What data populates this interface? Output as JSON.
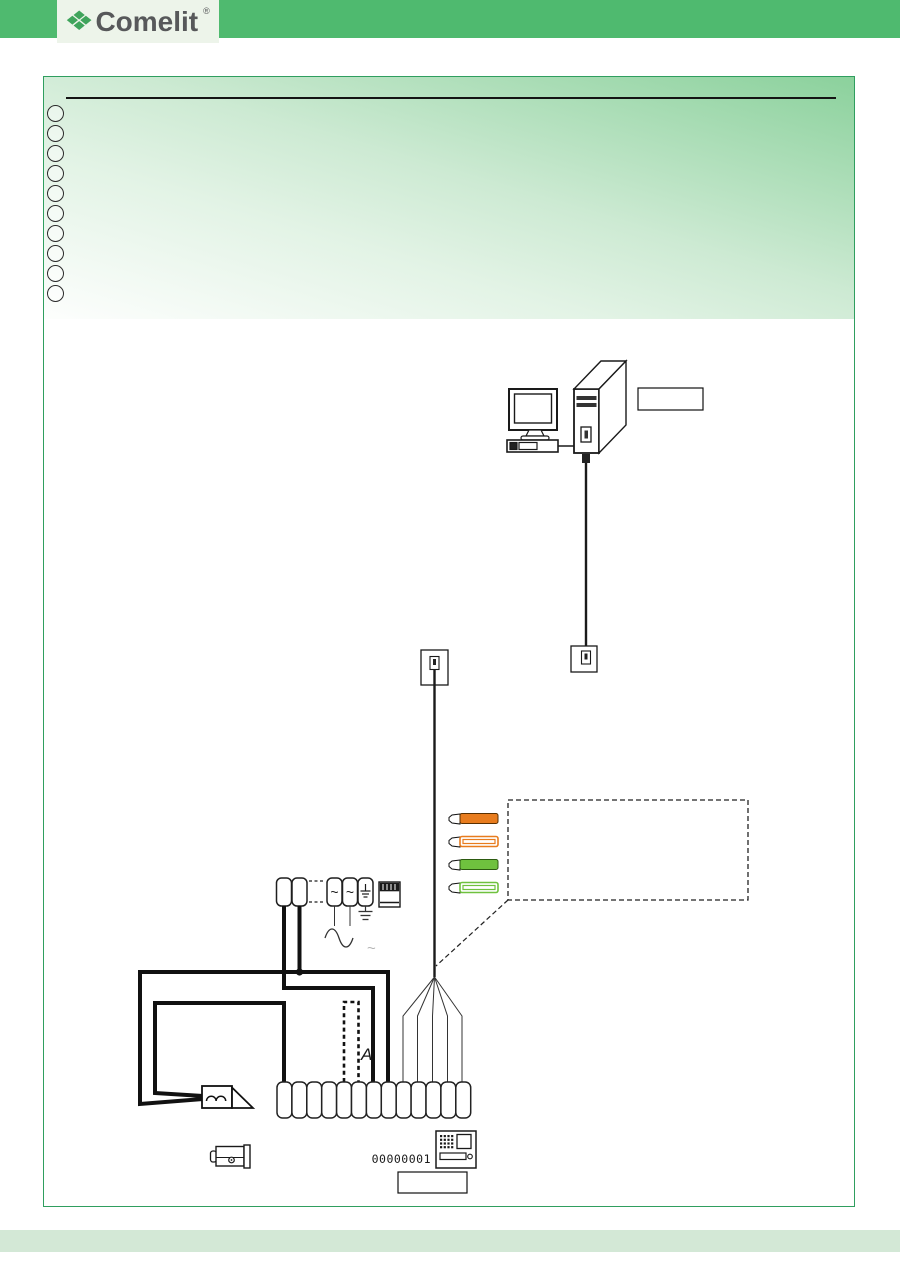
{
  "page": {
    "brand": {
      "logo_text": "Comelit",
      "registered_mark": "®",
      "logo_mark_glyph": "❖"
    },
    "colors": {
      "top_bar": "#4fba6f",
      "frame_border": "#2f9e5f",
      "header_gradient_dark": "#8bd19c",
      "bottom_band": "#d3e8d6",
      "line": "#1a1a1a",
      "wire_orange": "#e87c1e",
      "wire_green": "#6fc13e"
    },
    "header": {
      "bullet_count": 10
    }
  },
  "diagram": {
    "computer_label_box_text": "",
    "output_label_box_text": "",
    "legend_note_box_text": "",
    "device_id": "00000001",
    "ac_symbol": "~",
    "ac_symbol_small": "~",
    "jumper_switch_label": "A",
    "terminal_strip": {
      "count": 13
    },
    "cable_wires": [
      {
        "name": "orange-solid",
        "color": "#e87c1e",
        "style": "solid"
      },
      {
        "name": "orange-white-stripe",
        "color": "#e87c1e",
        "style": "striped"
      },
      {
        "name": "green-solid",
        "color": "#6fc13e",
        "style": "solid"
      },
      {
        "name": "green-white-stripe",
        "color": "#6fc13e",
        "style": "striped"
      }
    ],
    "icons": [
      "computer-pc-icon",
      "serial-socket-icon",
      "rj-plug-icon",
      "power-supply-icon",
      "ac-sine-icon",
      "earth-ground-icon",
      "buzzer-icon",
      "door-lock-release-icon",
      "entrance-panel-icon"
    ]
  }
}
